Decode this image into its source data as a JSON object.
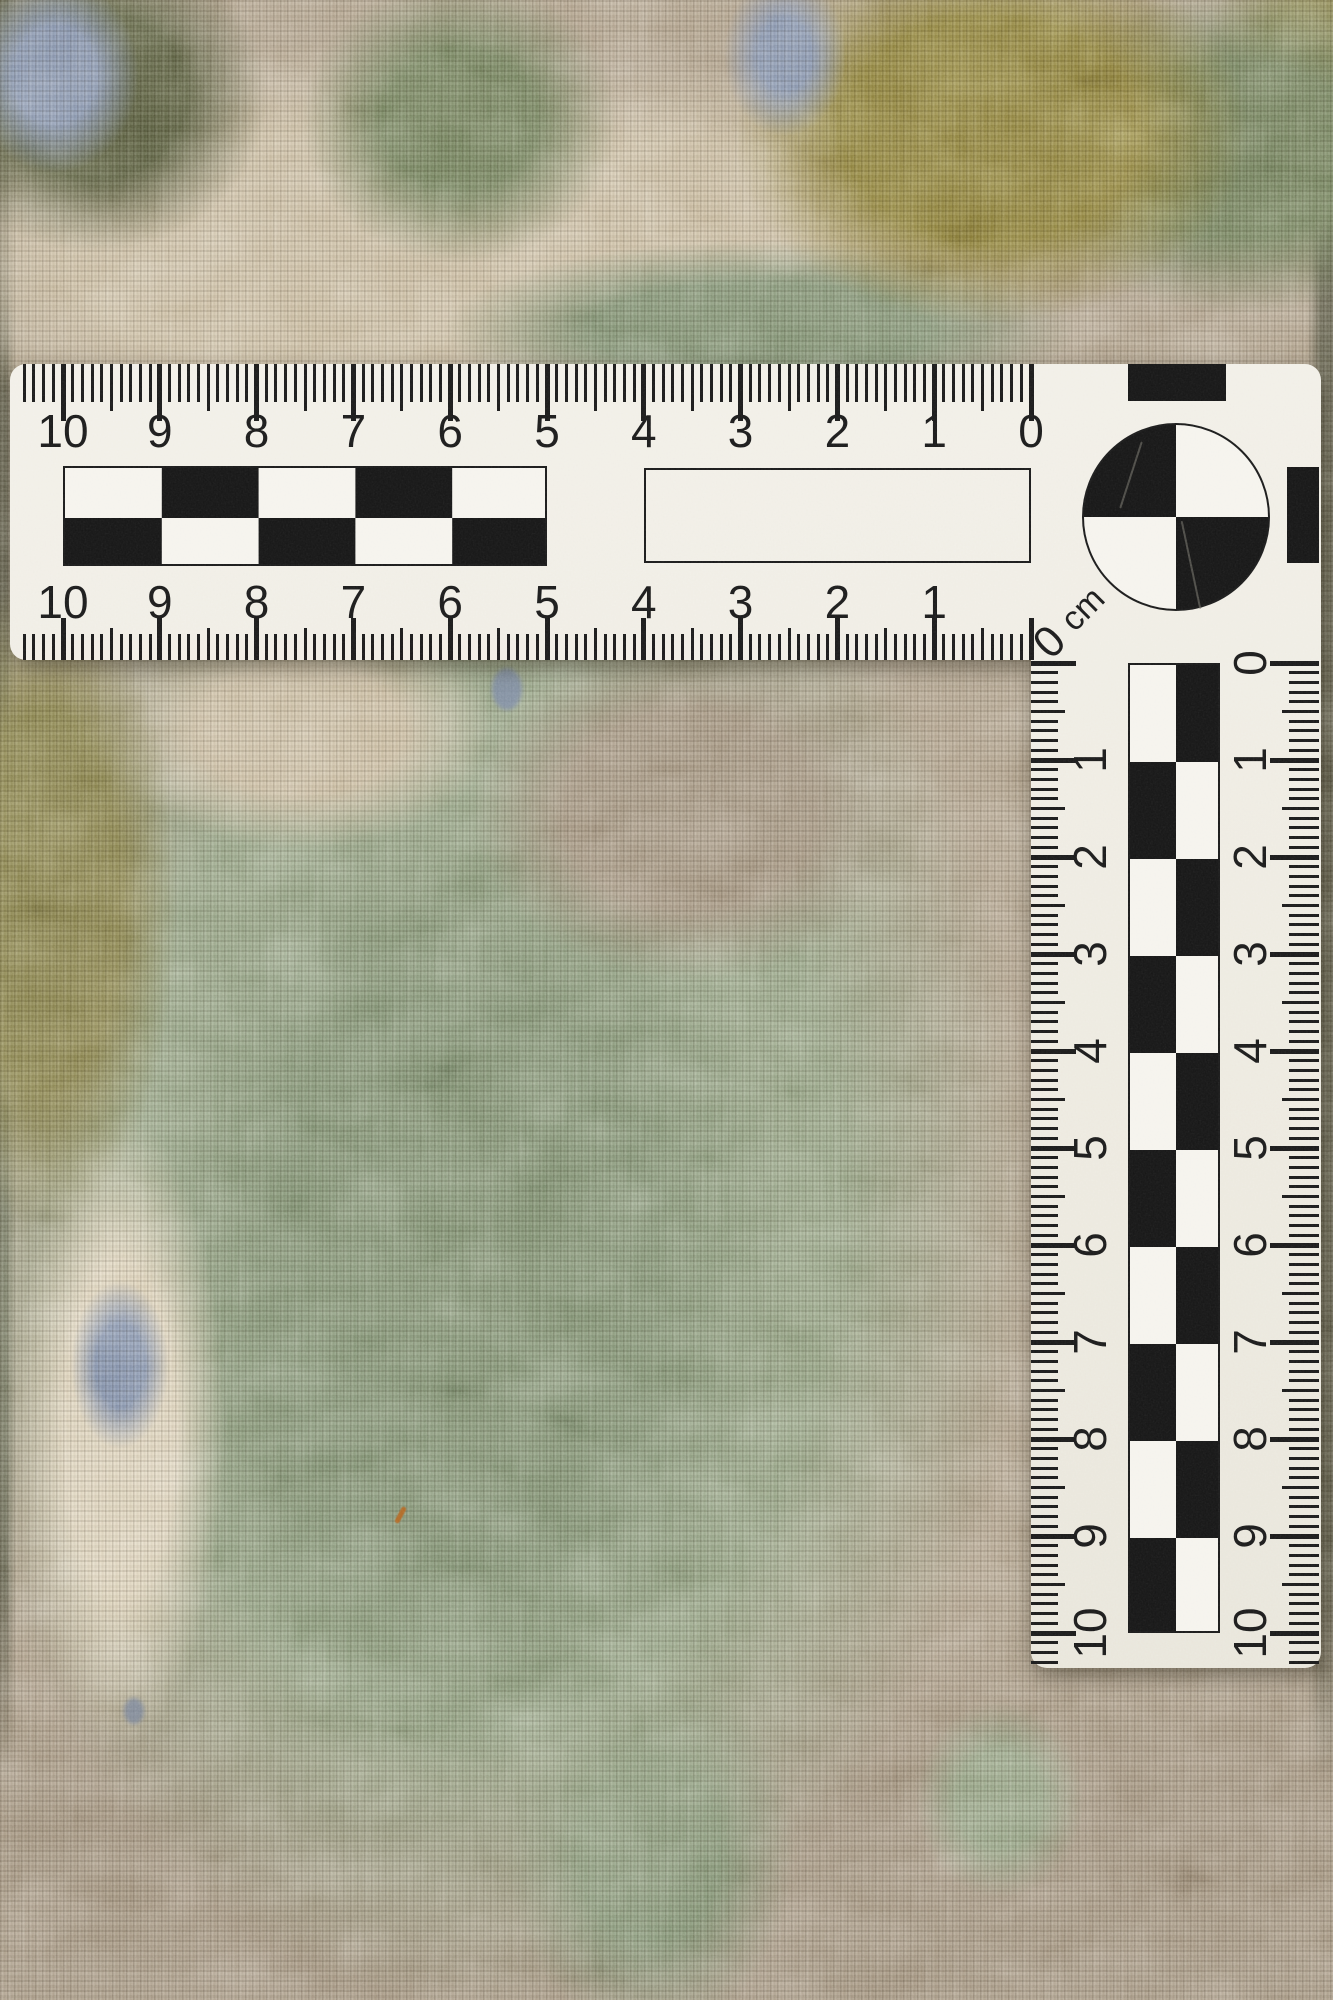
{
  "scene": {
    "description": "Close-up photograph of a hand-woven wool textile (sage green, beige, olive and blue-grey yarns) with a white L-shaped centimetre photo scale laid on top",
    "objects": [
      "woven-carpet",
      "l-shaped-cm-scale"
    ]
  },
  "ruler": {
    "unit_label": "cm",
    "corner_zero_label": "0",
    "horizontal": {
      "top_numbers": [
        "10",
        "9",
        "8",
        "7",
        "6",
        "5",
        "4",
        "3",
        "2",
        "1",
        "0"
      ],
      "bottom_numbers": [
        "10",
        "9",
        "8",
        "7",
        "6",
        "5",
        "4",
        "3",
        "2",
        "1"
      ],
      "cm_count": 10,
      "mm_per_cm": 10
    },
    "vertical": {
      "left_numbers": [
        "1",
        "2",
        "3",
        "4",
        "5",
        "6",
        "7",
        "8",
        "9",
        "10"
      ],
      "right_numbers": [
        "0",
        "1",
        "2",
        "3",
        "4",
        "5",
        "6",
        "7",
        "8",
        "9",
        "10"
      ],
      "cm_count": 10,
      "mm_per_cm": 10
    },
    "features": [
      "mm-tick-strips-on-both-edges",
      "checkerboard-cm-bands",
      "empty-outline-box",
      "quadrant-circle-registration-target",
      "black-edge-calibration-rectangles"
    ]
  },
  "palette": {
    "base": "#b1a28c",
    "beigeTop": "#cbbda2",
    "cream": "#ded3bb",
    "sage": "#93a283",
    "sageDeep": "#7e9070",
    "green": "#6f7f58",
    "oliveGold": "#8c7f35",
    "oliveDark": "#555a3a",
    "khaki": "#857f46",
    "blue": "#8291ad",
    "taupe": "#a2937e",
    "shadowEdge": "#5e5c48",
    "ink": "#1b1b1b",
    "face": "#f1efe9",
    "checkerDark": "#171717",
    "checkerLight": "#f5f3ed",
    "orange": "#b06a28"
  }
}
